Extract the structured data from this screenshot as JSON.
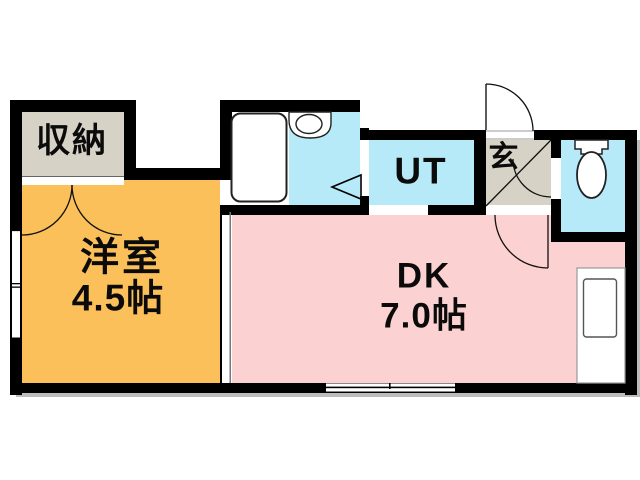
{
  "floorplan": {
    "rooms": {
      "closet": {
        "label": "収納"
      },
      "western": {
        "label": "洋室",
        "size": "4.5帖"
      },
      "dk": {
        "label": "DK",
        "size": "7.0帖"
      },
      "utility": {
        "label": "UT"
      },
      "entrance": {
        "label": "玄"
      }
    },
    "colors": {
      "wall": "#000000",
      "western_room": "#FBC05A",
      "dk_room": "#FCD1D1",
      "wet_area": "#B7EAF8",
      "closet_area": "#D6D2C6",
      "entrance_area": "#D6D2C6",
      "shadow": "#A5A5A5"
    },
    "fixtures": {
      "bathtub": "bathtub-icon",
      "sink": "sink-icon",
      "toilet": "toilet-icon",
      "kitchen_sink": "kitchen-sink-icon",
      "entrance_door": "entrance-door-icon",
      "closet_doors": "double-door-icon",
      "windows": "sliding-window-icon"
    }
  }
}
